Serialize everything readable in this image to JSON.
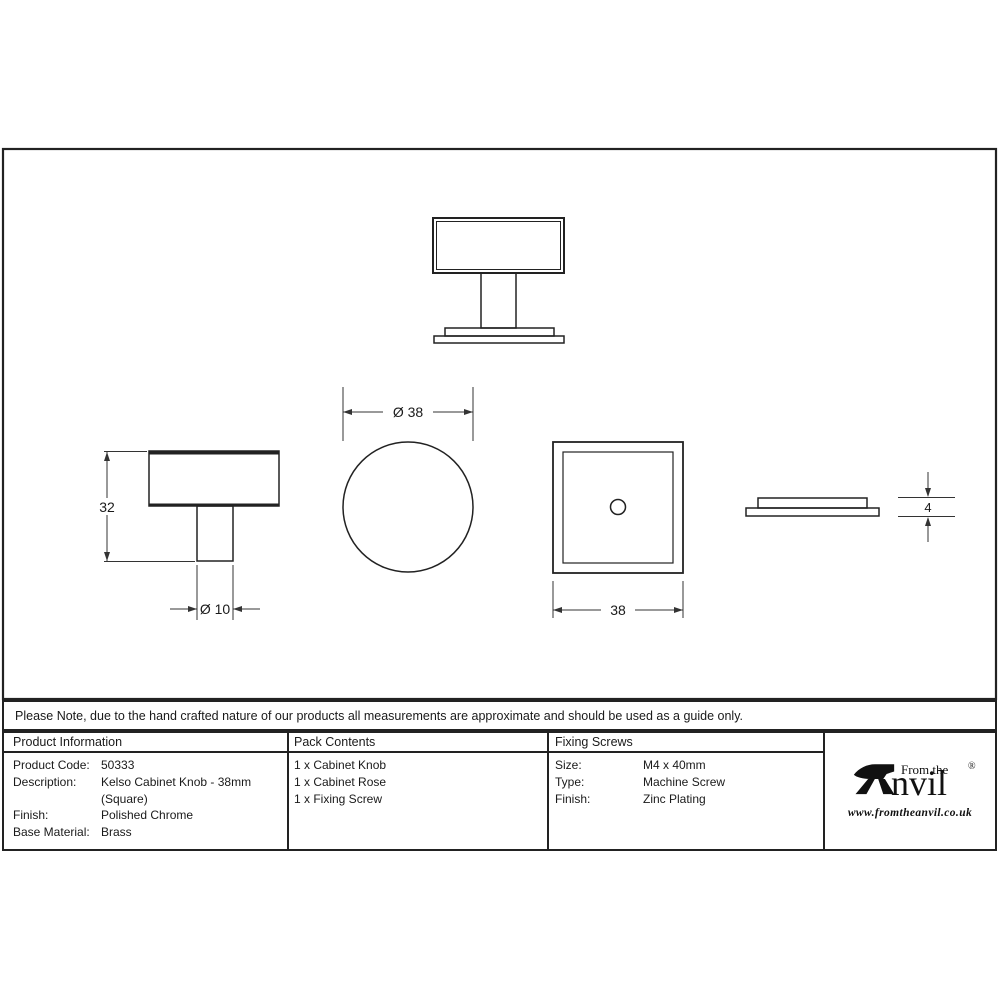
{
  "note": "Please Note, due to the hand crafted nature of our products all measurements are approximate and should be used as a guide only.",
  "drawing": {
    "dim_knob_height": "32",
    "dim_stem_diameter": "Ø 10",
    "dim_knob_diameter": "Ø 38",
    "dim_square_width": "38",
    "dim_rose_thickness": "4"
  },
  "table": {
    "product_information": {
      "header": "Product Information",
      "rows": [
        {
          "label": "Product Code:",
          "value": "50333"
        },
        {
          "label": "Description:",
          "value": "Kelso Cabinet Knob - 38mm"
        },
        {
          "label": "",
          "value": "(Square)"
        },
        {
          "label": "Finish:",
          "value": "Polished Chrome"
        },
        {
          "label": "Base Material:",
          "value": "Brass"
        }
      ]
    },
    "pack_contents": {
      "header": "Pack Contents",
      "items": [
        "1 x Cabinet Knob",
        "1 x Cabinet Rose",
        "1 x Fixing Screw"
      ]
    },
    "fixing_screws": {
      "header": "Fixing Screws",
      "rows": [
        {
          "label": "Size:",
          "value": "M4 x 40mm"
        },
        {
          "label": "Type:",
          "value": "Machine Screw"
        },
        {
          "label": "Finish:",
          "value": "Zinc Plating"
        }
      ]
    }
  },
  "logo": {
    "tagline": "From the",
    "brand": "nvil",
    "registered": "®",
    "website": "www.fromtheanvil.co.uk"
  },
  "colors": {
    "line": "#222222",
    "text": "#1a1a1a"
  }
}
